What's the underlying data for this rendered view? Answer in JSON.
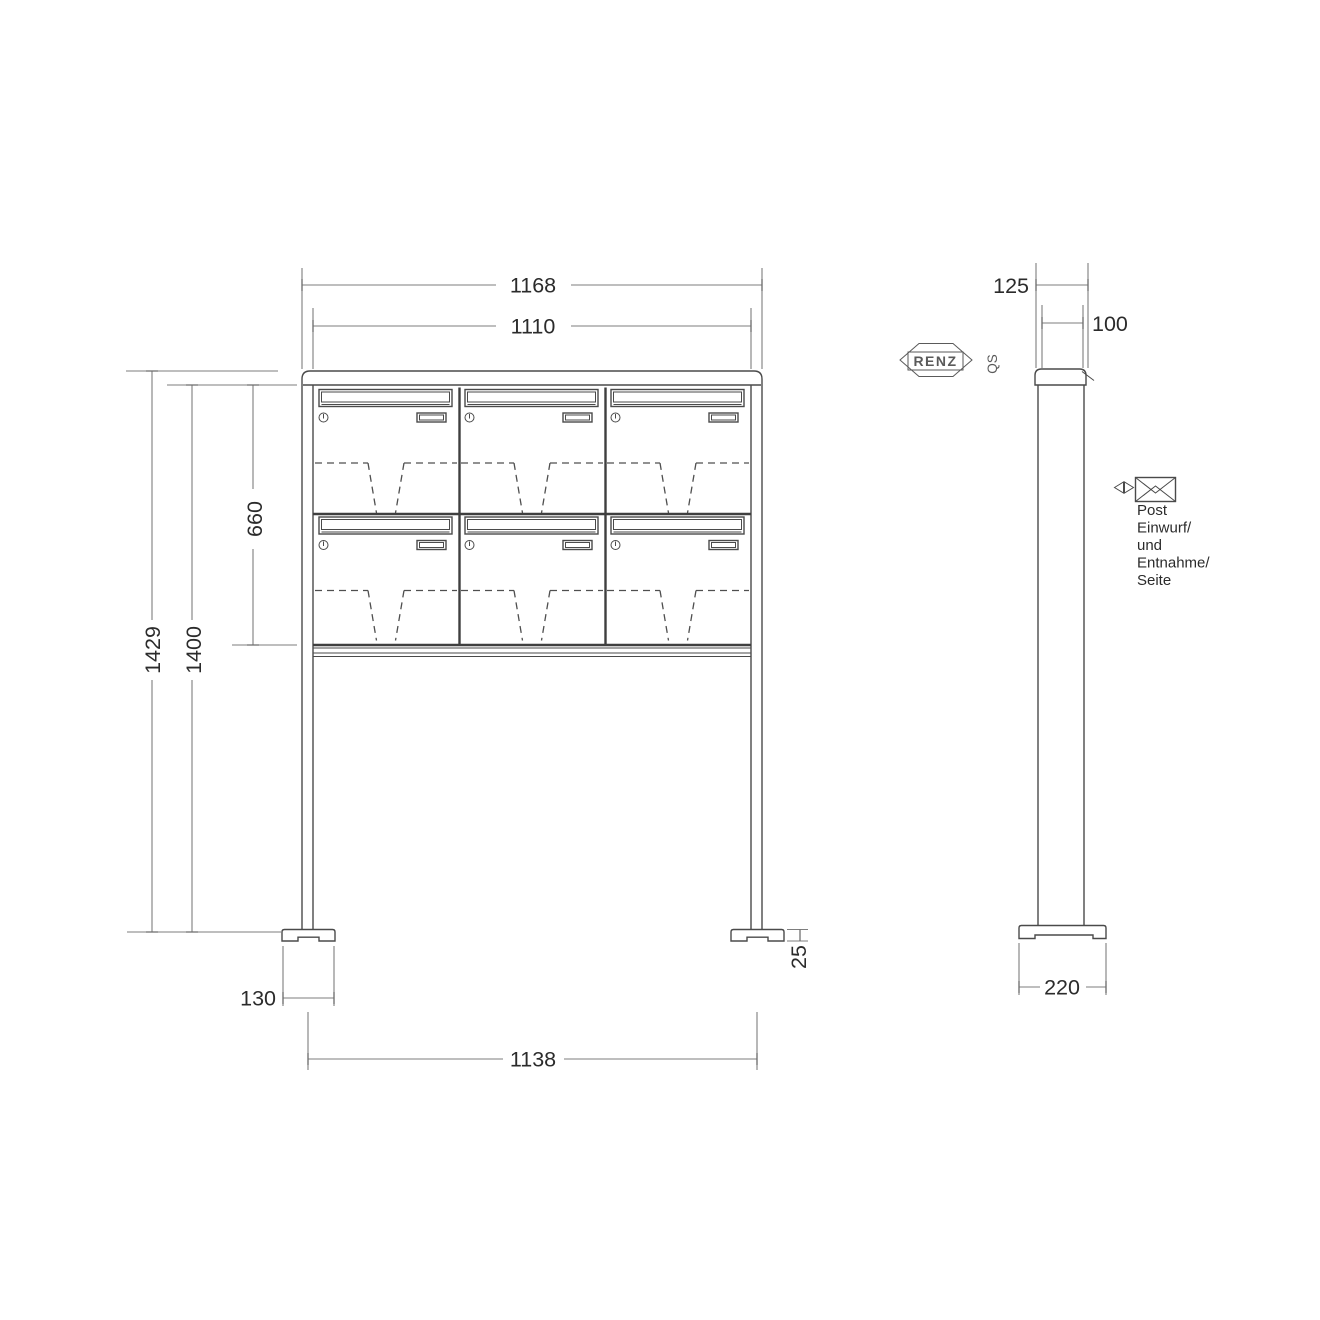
{
  "page": {
    "background": "#ffffff"
  },
  "colors": {
    "object_line": "#4a4a4a",
    "dimension_line": "#7e7e7e",
    "text": "#2b2b2b"
  },
  "front_view": {
    "dimensions": {
      "outer_width": "1168",
      "inner_width": "1110",
      "cabinet_height": "660",
      "total_height": "1429",
      "stand_height": "1400",
      "foot_plate_width": "130",
      "post_spacing": "1138",
      "foot_plate_height": "25"
    }
  },
  "side_view": {
    "dimensions": {
      "frame_depth": "125",
      "box_depth": "100",
      "foot_plate_depth": "220"
    }
  },
  "branding": {
    "logo": "RENZ",
    "quality_label": "QS"
  },
  "annotation": {
    "lines": [
      "Post",
      "Einwurf/",
      "und",
      "Entnahme/",
      "Seite"
    ]
  },
  "mailbox_grid": {
    "rows": 2,
    "columns": 3
  }
}
